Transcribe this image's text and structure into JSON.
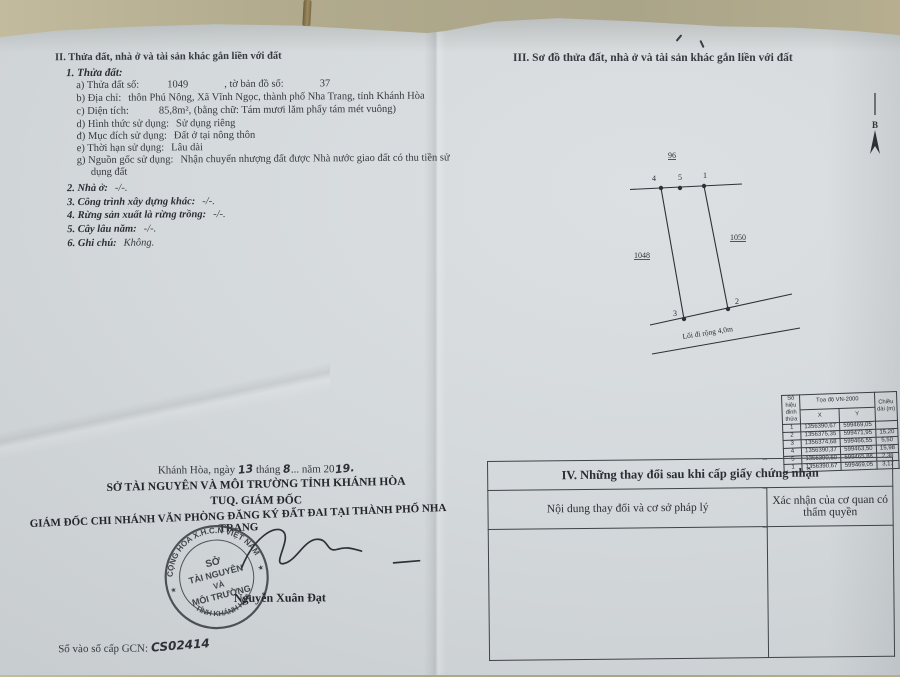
{
  "left": {
    "section_title": "II. Thửa đất, nhà ở và tài sản khác gắn liền với đất",
    "parcel_heading": "1. Thửa đất:",
    "a_label": "a) Thửa đất số:",
    "a_value": "1049",
    "a_label2": ", tờ bản đồ số:",
    "a_value2": "37",
    "b_label": "b) Địa chỉ:",
    "b_value": "thôn Phú Nông, Xã Vĩnh Ngọc, thành phố Nha Trang, tỉnh Khánh Hòa",
    "c_label": "c) Diện tích:",
    "c_value": "85,8m², (bằng chữ: Tám mươi lăm phẩy tám mét vuông)",
    "d_label": "d) Hình thức sử dụng:",
    "d_value": "Sử dụng riêng",
    "dd_label": "đ) Mục đích sử dụng:",
    "dd_value": "Đất ở tại nông thôn",
    "e_label": "e) Thời hạn sử dụng:",
    "e_value": "Lâu dài",
    "g_label": "g) Nguồn gốc sử dụng:",
    "g_value1": "Nhận chuyển nhượng đất được Nhà nước giao đất có thu tiền sử",
    "g_value2": "dụng đất",
    "item2_label": "2. Nhà ở:",
    "item2_value": "-/-.",
    "item3_label": "3. Công trình xây dựng khác:",
    "item3_value": "-/-.",
    "item4_label": "4. Rừng sản xuất là rừng trồng:",
    "item4_value": "-/-.",
    "item5_label": "5. Cây lâu năm:",
    "item5_value": "-/-.",
    "item6_label": "6. Ghi chú:",
    "item6_value": "Không.",
    "date_prefix": "Khánh Hòa, ngày",
    "date_day": "13",
    "date_mid": "tháng",
    "date_month": "8",
    "date_dots": "...",
    "date_suffix": "năm 20",
    "date_year": "19.",
    "org_line": "SỞ TÀI NGUYÊN VÀ MÔI TRƯỜNG TỈNH KHÁNH HÒA",
    "tuq_line": "TUQ. GIÁM ĐỐC",
    "director_line": "GIÁM ĐỐC CHI NHÁNH VĂN PHÒNG ĐĂNG KÝ ĐẤT ĐAI TẠI THÀNH PHỐ NHA TRANG",
    "signer_name": "Nguyễn Xuân Đạt",
    "seal": {
      "top_arc": "CỘNG HÒA X.H.C.N VIỆT NAM",
      "center1": "SỞ",
      "center2": "TÀI NGUYÊN",
      "center3": "VÀ",
      "center4": "MÔI TRƯỜNG",
      "bottom_arc": "TỈNH KHÁNH HÒA",
      "star_left": "★",
      "star_right": "★"
    },
    "gcn_label": "Số vào sổ cấp GCN:",
    "gcn_value": "CS02414"
  },
  "right": {
    "section_title": "III. Sơ đồ thửa đất, nhà ở và tài sản khác gắn liền với đất",
    "diagram": {
      "north_label": "B",
      "adjacent_top": "96",
      "adjacent_left": "1048",
      "adjacent_right": "1050",
      "vertex_labels": [
        "4",
        "5",
        "1",
        "2",
        "3"
      ],
      "road_label": "Lối đi rộng 4,0m"
    },
    "coord_table": {
      "header_id": "Số hiệu đỉnh thửa",
      "header_coord": "Tọa độ VN-2000",
      "header_x": "X",
      "header_y": "Y",
      "header_len": "Chiều dài (m)",
      "rows": [
        {
          "id": "1",
          "x": "1356390,67",
          "y": "599469,05",
          "len": ""
        },
        {
          "id": "2",
          "x": "1356375,35",
          "y": "599471,95",
          "len": "15,20"
        },
        {
          "id": "3",
          "x": "1356374,68",
          "y": "599466,55",
          "len": "5,50"
        },
        {
          "id": "4",
          "x": "1356390,37",
          "y": "599463,50",
          "len": "15,98"
        },
        {
          "id": "5",
          "x": "1356390,50",
          "y": "599465,88",
          "len": "2,38"
        },
        {
          "id": "1",
          "x": "1356390,67",
          "y": "599469,05",
          "len": "3,17"
        }
      ]
    },
    "section4": {
      "title": "IV. Những thay đổi sau khi cấp giấy chứng nhận",
      "col1": "Nội dung thay đổi và cơ sở pháp lý",
      "col2": "Xác nhận của cơ quan có thẩm quyền"
    }
  }
}
